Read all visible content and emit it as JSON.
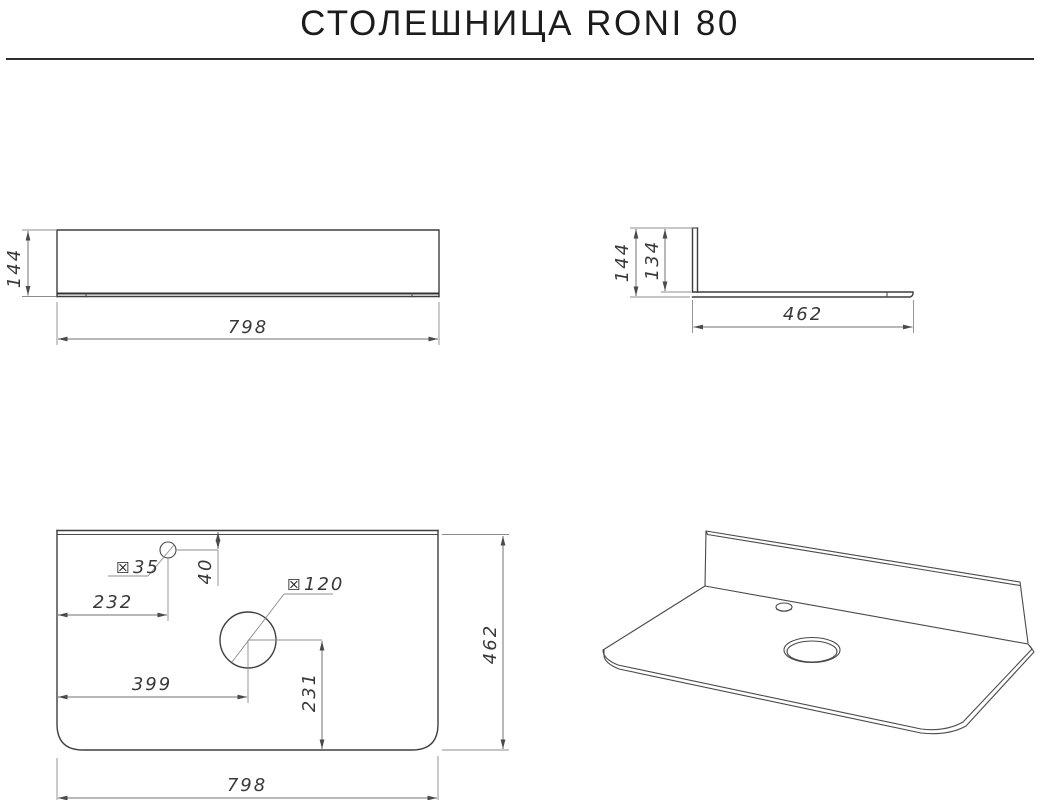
{
  "page": {
    "title": "СТОЛЕШНИЦА RONI 80"
  },
  "symbols": {
    "diameter": "☒"
  },
  "views": {
    "front": {
      "height": "144",
      "width": "798"
    },
    "side": {
      "height": "144",
      "inner_height": "134",
      "depth": "462"
    },
    "top": {
      "faucet_hole_diameter": "35",
      "faucet_hole_from_back": "40",
      "faucet_hole_from_left": "232",
      "sink_hole_diameter": "120",
      "sink_hole_from_left": "399",
      "sink_hole_from_front": "231",
      "depth": "462",
      "width": "798"
    }
  }
}
